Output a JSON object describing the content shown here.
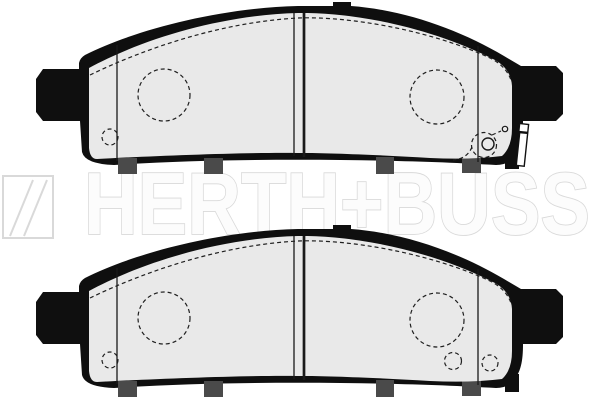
{
  "page": {
    "background_color": "#ffffff",
    "width": 600,
    "height": 400
  },
  "watermark": {
    "brand": "HERTH+BUSS",
    "outline_color": "#d9d9d9",
    "fill_color": "#fcfcfc",
    "logo": "herth-buss-flash-logo"
  },
  "drawing": {
    "subject": "disc brake pad set technical line drawing, two pads",
    "outline_color": "#0f0f0f",
    "pad_surface_color": "#e9e9e9",
    "tab_color": "#4a4a4a",
    "pads": [
      {
        "label": "upper brake pad with wear indicator clip"
      },
      {
        "label": "lower brake pad"
      }
    ]
  }
}
